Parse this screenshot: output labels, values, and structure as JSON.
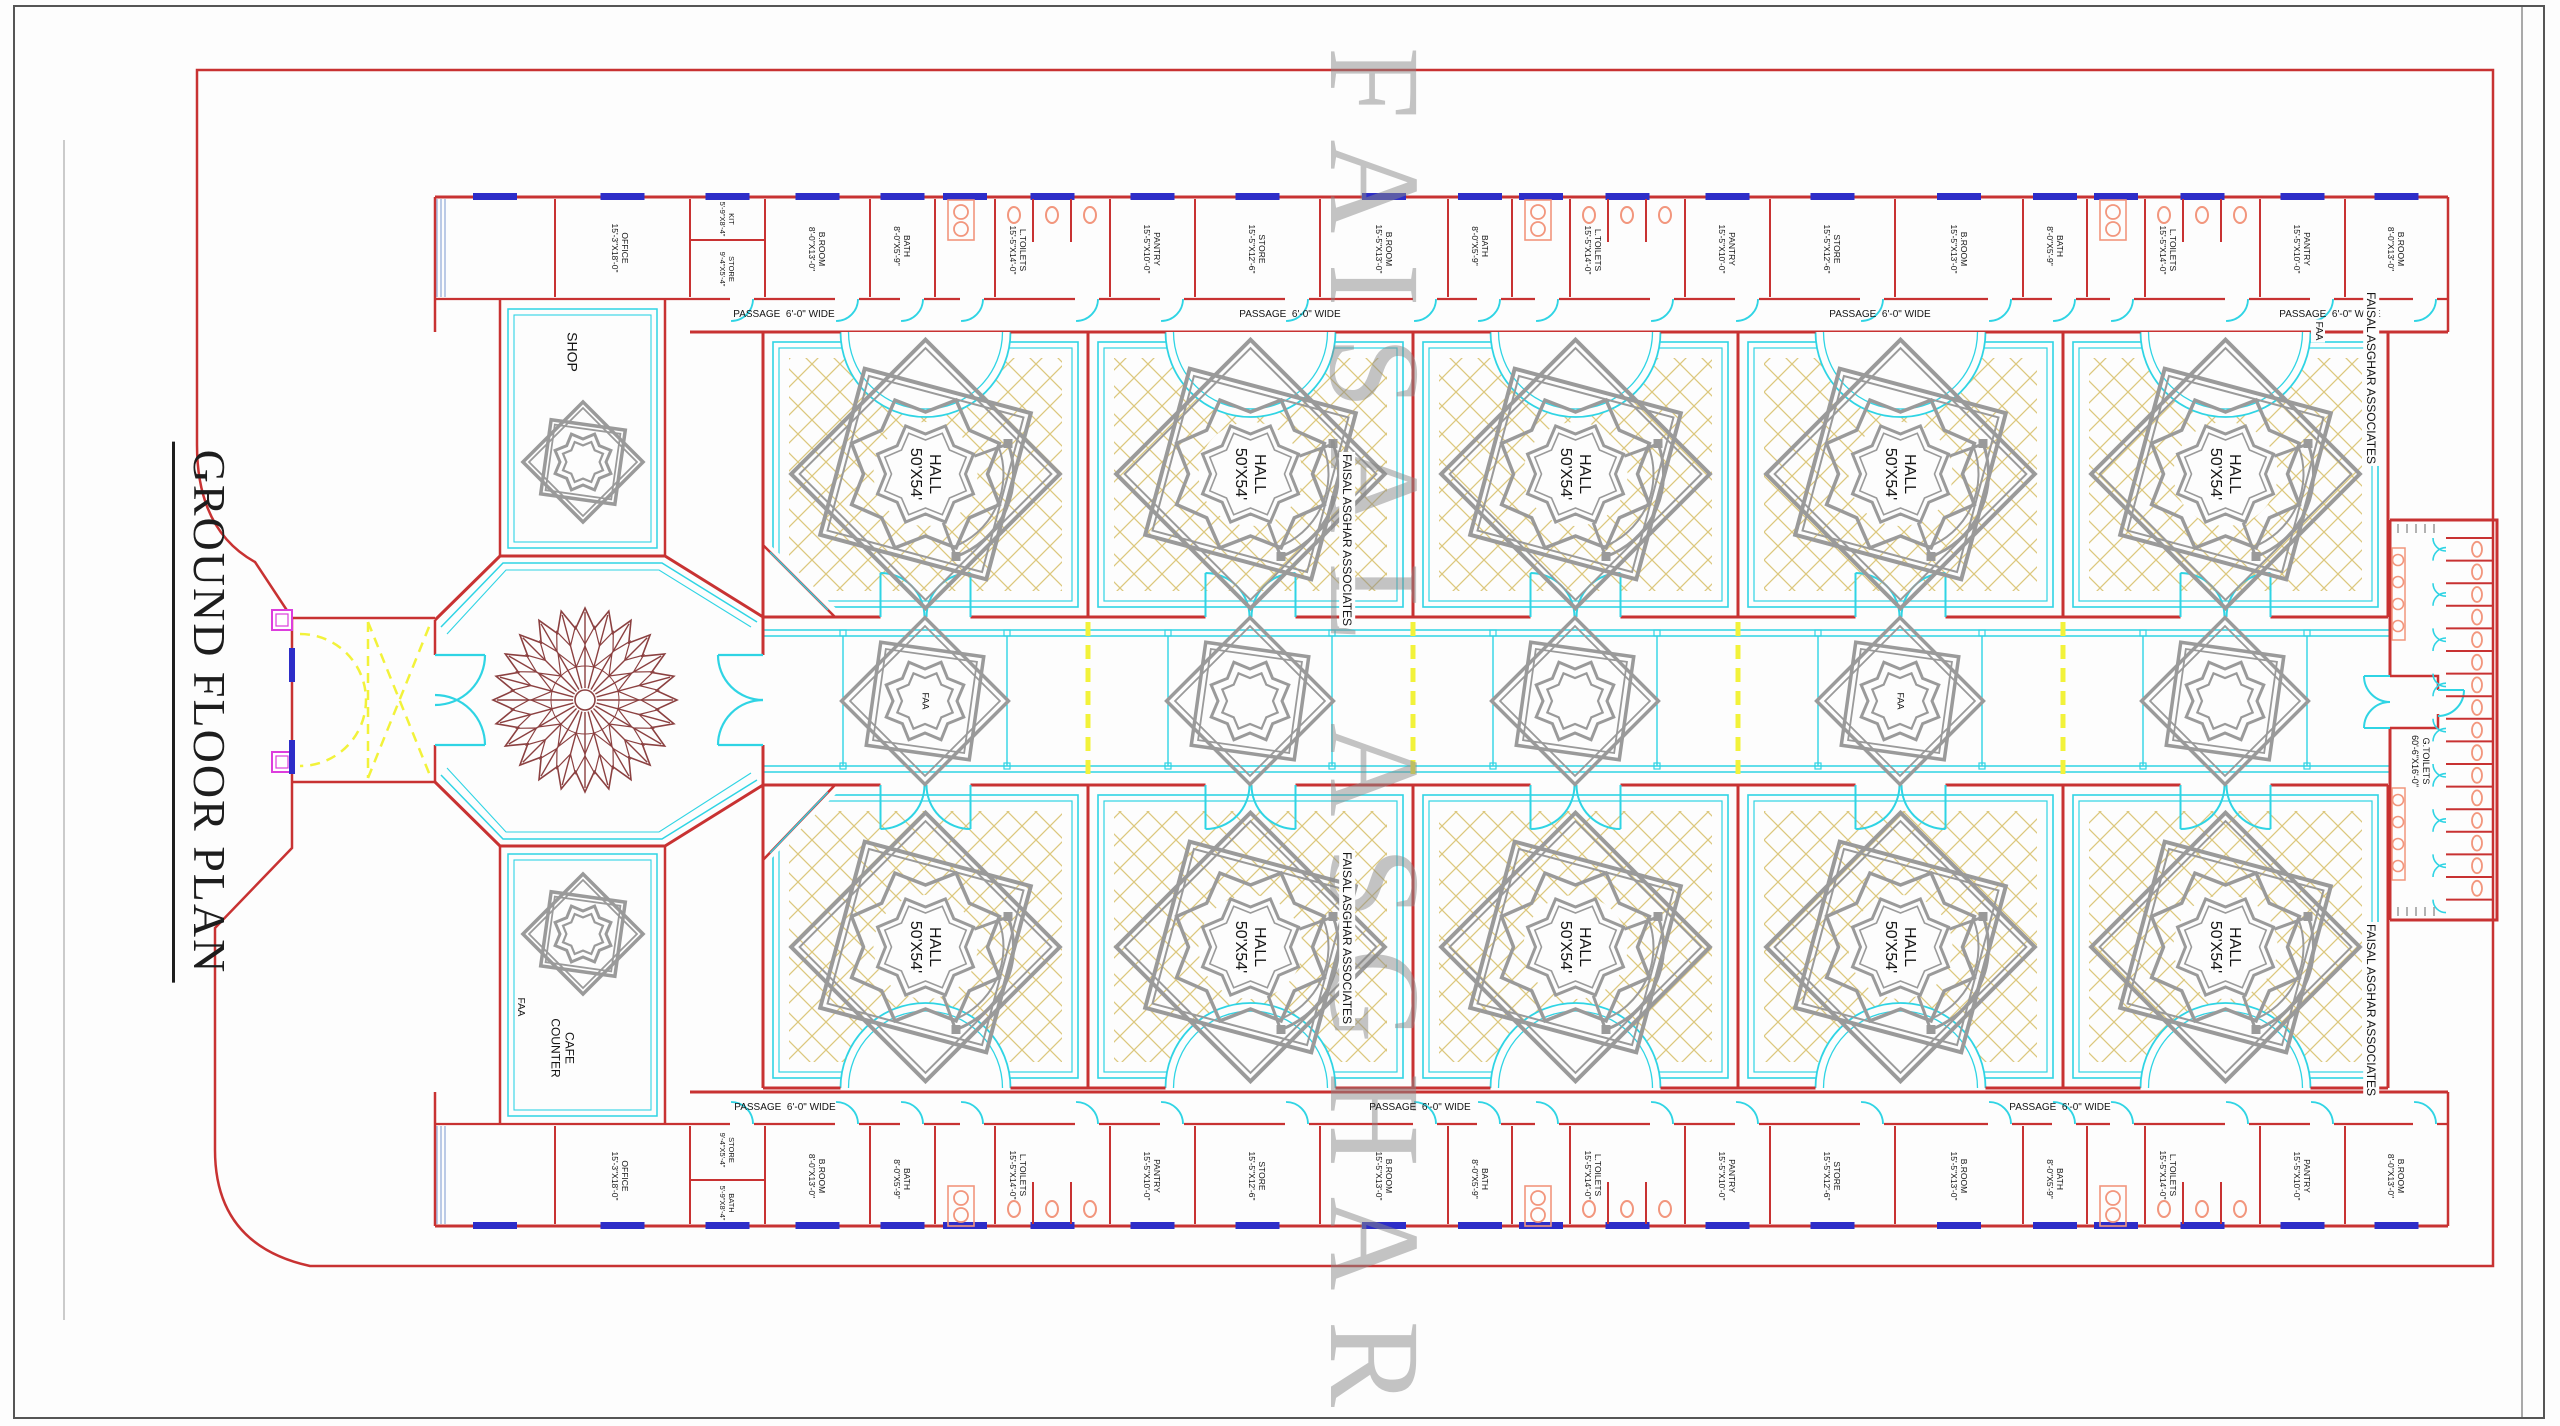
{
  "title": {
    "text": "GROUND FLOOR PLAN"
  },
  "watermark": {
    "big": "FAISAL ASGHAR",
    "firm": "FAISAL ASGHAR ASSOCIATES",
    "abbr": "FAA"
  },
  "colors": {
    "wall": "#c83232",
    "cyan": "#2fd4e4",
    "window_blue": "#2d2dc8",
    "hatch_tan": "#dcc87e",
    "ornament_gray": "#9a9a9a",
    "fixture_salmon": "#f2967d",
    "yellow": "#f2f23a",
    "magenta": "#dd3ddd",
    "rosette_brown": "#8b4040",
    "text": "#141414",
    "watermark_gray": "#8a8a8a"
  },
  "labels": [
    {
      "n": "passage-label",
      "t": "PASSAGE  6'-0\" WIDE",
      "x": 784,
      "y": 315,
      "fs": 10,
      "rot": 0
    },
    {
      "n": "passage-label",
      "t": "PASSAGE  6'-0\" WIDE",
      "x": 1290,
      "y": 315,
      "fs": 10,
      "rot": 0
    },
    {
      "n": "passage-label",
      "t": "PASSAGE  6'-0\" WIDE",
      "x": 1880,
      "y": 315,
      "fs": 10,
      "rot": 0
    },
    {
      "n": "passage-label",
      "t": "PASSAGE  6'-0\" WIDE",
      "x": 2330,
      "y": 315,
      "fs": 10,
      "rot": 0
    },
    {
      "n": "passage-label",
      "t": "PASSAGE  6'-0\" WIDE",
      "x": 785,
      "y": 1108,
      "fs": 10,
      "rot": 0
    },
    {
      "n": "passage-label",
      "t": "PASSAGE  6'-0\" WIDE",
      "x": 1420,
      "y": 1108,
      "fs": 10,
      "rot": 0
    },
    {
      "n": "passage-label",
      "t": "PASSAGE  6'-0\" WIDE",
      "x": 2060,
      "y": 1108,
      "fs": 10,
      "rot": 0
    },
    {
      "n": "hall-label",
      "t": "HALL\n50'X54'",
      "x": 925,
      "y": 474,
      "fs": 16
    },
    {
      "n": "hall-label",
      "t": "HALL\n50'X54'",
      "x": 1250,
      "y": 474,
      "fs": 16
    },
    {
      "n": "hall-label",
      "t": "HALL\n50'X54'",
      "x": 1575,
      "y": 474,
      "fs": 16
    },
    {
      "n": "hall-label",
      "t": "HALL\n50'X54'",
      "x": 1900,
      "y": 474,
      "fs": 16
    },
    {
      "n": "hall-label",
      "t": "HALL\n50'X54'",
      "x": 2225,
      "y": 474,
      "fs": 16
    },
    {
      "n": "hall-label",
      "t": "HALL\n50'X54'",
      "x": 925,
      "y": 947,
      "fs": 16
    },
    {
      "n": "hall-label",
      "t": "HALL\n50'X54'",
      "x": 1250,
      "y": 947,
      "fs": 16
    },
    {
      "n": "hall-label",
      "t": "HALL\n50'X54'",
      "x": 1575,
      "y": 947,
      "fs": 16
    },
    {
      "n": "hall-label",
      "t": "HALL\n50'X54'",
      "x": 1900,
      "y": 947,
      "fs": 16
    },
    {
      "n": "hall-label",
      "t": "HALL\n50'X54'",
      "x": 2225,
      "y": 947,
      "fs": 16
    },
    {
      "n": "faa-ornament-label",
      "t": "FAA",
      "x": 925,
      "y": 701,
      "fs": 9
    },
    {
      "n": "faa-ornament-label",
      "t": "FAA",
      "x": 1900,
      "y": 701,
      "fs": 9
    },
    {
      "n": "faa-label",
      "t": "FAA",
      "x": 520,
      "y": 1007,
      "fs": 10
    },
    {
      "n": "faa-label",
      "t": "FAA",
      "x": 2318,
      "y": 331,
      "fs": 10,
      "bg": 1
    },
    {
      "n": "firm-label",
      "t": "FAISAL ASGHAR ASSOCIATES",
      "x": 1347,
      "y": 540,
      "fs": 12,
      "bg": 1
    },
    {
      "n": "firm-label",
      "t": "FAISAL ASGHAR ASSOCIATES",
      "x": 1347,
      "y": 938,
      "fs": 12,
      "bg": 1
    },
    {
      "n": "firm-label",
      "t": "FAISAL ASGHAR ASSOCIATES",
      "x": 2371,
      "y": 378,
      "fs": 12,
      "bg": 1
    },
    {
      "n": "firm-label",
      "t": "FAISAL ASGHAR ASSOCIATES",
      "x": 2371,
      "y": 1010,
      "fs": 12,
      "bg": 1
    },
    {
      "n": "shop-label",
      "t": "SHOP",
      "x": 572,
      "y": 352,
      "fs": 14
    },
    {
      "n": "cafe-label",
      "t": "CAFE\nCOUNTER",
      "x": 562,
      "y": 1048,
      "fs": 12
    },
    {
      "n": "toilets-label",
      "t": "G.TOILETS\n60'-6\"X16'-0\"",
      "x": 2420,
      "y": 761,
      "fs": 9
    },
    {
      "n": "room-label",
      "t": "OFFICE\n15'-3\"X18'-0\"",
      "x": 620,
      "y": 248,
      "fs": 8.5
    },
    {
      "n": "room-label",
      "t": "KIT\n5'-9\"X8'-4\"",
      "x": 727,
      "y": 219,
      "fs": 7.5
    },
    {
      "n": "room-label",
      "t": "STORE\n9'-4\"X5'-4\"",
      "x": 727,
      "y": 269,
      "fs": 7.5
    },
    {
      "n": "room-label",
      "t": "B.ROOM\n8'-0\"X13'-0\"",
      "x": 817,
      "y": 249,
      "fs": 8.5
    },
    {
      "n": "room-label",
      "t": "BATH\n8'-0\"X5'-9\"",
      "x": 902,
      "y": 246,
      "fs": 8.5
    },
    {
      "n": "room-label",
      "t": "L.TOILETS\n15'-5\"X14'-0\"",
      "x": 1018,
      "y": 250,
      "fs": 8.5
    },
    {
      "n": "room-label",
      "t": "PANTRY\n15'-5\"X10'-0\"",
      "x": 1152,
      "y": 249,
      "fs": 8.5
    },
    {
      "n": "room-label",
      "t": "STORE\n15'-5\"X12'-6\"",
      "x": 1257,
      "y": 249,
      "fs": 8.5
    },
    {
      "n": "room-label",
      "t": "B.ROOM\n15'-5\"X13'-0\"",
      "x": 1384,
      "y": 249,
      "fs": 8.5
    },
    {
      "n": "room-label",
      "t": "BATH\n8'-0\"X5'-9\"",
      "x": 1480,
      "y": 246,
      "fs": 8.5
    },
    {
      "n": "room-label",
      "t": "L.TOILETS\n15'-5\"X14'-0\"",
      "x": 1593,
      "y": 250,
      "fs": 8.5
    },
    {
      "n": "room-label",
      "t": "PANTRY\n15'-5\"X10'-0\"",
      "x": 1727,
      "y": 249,
      "fs": 8.5
    },
    {
      "n": "room-label",
      "t": "STORE\n15'-5\"X12'-6\"",
      "x": 1832,
      "y": 249,
      "fs": 8.5
    },
    {
      "n": "room-label",
      "t": "B.ROOM\n15'-5\"X13'-0\"",
      "x": 1959,
      "y": 249,
      "fs": 8.5
    },
    {
      "n": "room-label",
      "t": "BATH\n8'-0\"X5'-9\"",
      "x": 2055,
      "y": 246,
      "fs": 8.5
    },
    {
      "n": "room-label",
      "t": "L.TOILETS\n15'-5\"X14'-0\"",
      "x": 2168,
      "y": 250,
      "fs": 8.5
    },
    {
      "n": "room-label",
      "t": "PANTRY\n15'-5\"X10'-0\"",
      "x": 2302,
      "y": 249,
      "fs": 8.5
    },
    {
      "n": "room-label",
      "t": "B.ROOM\n8'-0\"X13'-0\"",
      "x": 2396,
      "y": 249,
      "fs": 8.5
    },
    {
      "n": "room-label",
      "t": "OFFICE\n15'-3\"X18'-0\"",
      "x": 620,
      "y": 1176,
      "fs": 8.5
    },
    {
      "n": "room-label",
      "t": "STORE\n9'-4\"X5'-4\"",
      "x": 727,
      "y": 1150,
      "fs": 7.5
    },
    {
      "n": "room-label",
      "t": "BATH\n5'-9\"X8'-4\"",
      "x": 727,
      "y": 1203,
      "fs": 7.5
    },
    {
      "n": "room-label",
      "t": "B.ROOM\n8'-0\"X13'-0\"",
      "x": 817,
      "y": 1176,
      "fs": 8.5
    },
    {
      "n": "room-label",
      "t": "BATH\n8'-0\"X5'-9\"",
      "x": 902,
      "y": 1179,
      "fs": 8.5
    },
    {
      "n": "room-label",
      "t": "L.TOILETS\n15'-5\"X14'-0\"",
      "x": 1018,
      "y": 1175,
      "fs": 8.5
    },
    {
      "n": "room-label",
      "t": "PANTRY\n15'-5\"X10'-0\"",
      "x": 1152,
      "y": 1176,
      "fs": 8.5
    },
    {
      "n": "room-label",
      "t": "STORE\n15'-5\"X12'-6\"",
      "x": 1257,
      "y": 1176,
      "fs": 8.5
    },
    {
      "n": "room-label",
      "t": "B.ROOM\n15'-5\"X13'-0\"",
      "x": 1384,
      "y": 1176,
      "fs": 8.5
    },
    {
      "n": "room-label",
      "t": "BATH\n8'-0\"X5'-9\"",
      "x": 1480,
      "y": 1179,
      "fs": 8.5
    },
    {
      "n": "room-label",
      "t": "L.TOILETS\n15'-5\"X14'-0\"",
      "x": 1593,
      "y": 1175,
      "fs": 8.5
    },
    {
      "n": "room-label",
      "t": "PANTRY\n15'-5\"X10'-0\"",
      "x": 1727,
      "y": 1176,
      "fs": 8.5
    },
    {
      "n": "room-label",
      "t": "STORE\n15'-5\"X12'-6\"",
      "x": 1832,
      "y": 1176,
      "fs": 8.5
    },
    {
      "n": "room-label",
      "t": "B.ROOM\n15'-5\"X13'-0\"",
      "x": 1959,
      "y": 1176,
      "fs": 8.5
    },
    {
      "n": "room-label",
      "t": "BATH\n8'-0\"X5'-9\"",
      "x": 2055,
      "y": 1179,
      "fs": 8.5
    },
    {
      "n": "room-label",
      "t": "L.TOILETS\n15'-5\"X14'-0\"",
      "x": 2168,
      "y": 1175,
      "fs": 8.5
    },
    {
      "n": "room-label",
      "t": "PANTRY\n15'-5\"X10'-0\"",
      "x": 2302,
      "y": 1176,
      "fs": 8.5
    },
    {
      "n": "room-label",
      "t": "B.ROOM\n8'-0\"X13'-0\"",
      "x": 2396,
      "y": 1176,
      "fs": 8.5
    }
  ]
}
